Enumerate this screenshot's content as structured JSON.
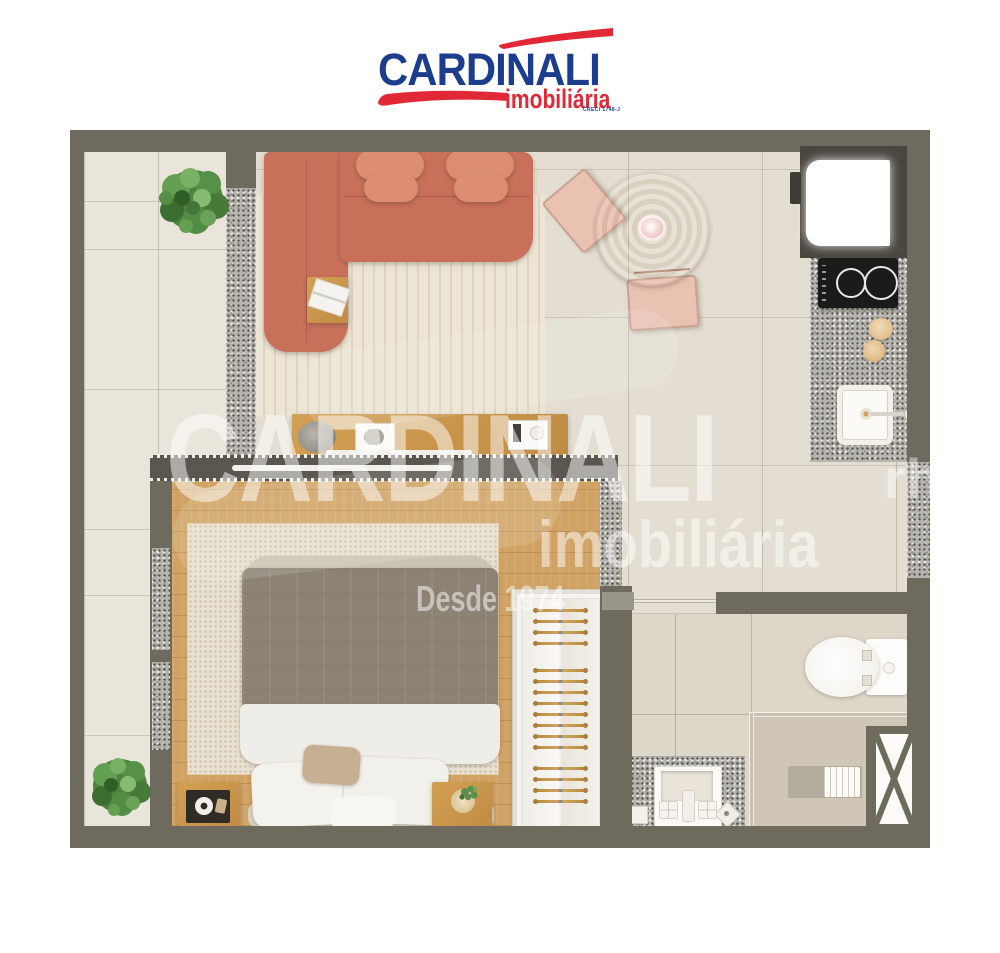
{
  "brand": {
    "name": "CARDINALI",
    "tagline": "imobiliária",
    "creci": "CRECI 1748-J",
    "colors": {
      "blue": "#1c3d8e",
      "red": "#e02837"
    }
  },
  "watermark": {
    "title": "CARDINALI",
    "subtitle": "imobiliária",
    "since": "Desde 1974",
    "fragment": "rh"
  },
  "floor_plan": {
    "description": "Top-down 3D rendered floor plan of a studio apartment",
    "rooms": [
      {
        "name": "balcony",
        "features": [
          "potted-plant-top",
          "potted-plant-bottom",
          "sliding-door-curtain"
        ]
      },
      {
        "name": "living-room",
        "features": [
          "l-shaped-coral-sofa",
          "two-coral-armchairs",
          "striped-area-rug",
          "side-table-with-magazines",
          "tv-console",
          "decor-bowl",
          "decor-trays",
          "soundbar"
        ]
      },
      {
        "name": "dining-area",
        "features": [
          "round-wood-table",
          "centerpiece-bowl",
          "two-pink-chairs"
        ]
      },
      {
        "name": "kitchen",
        "features": [
          "refrigerator",
          "two-burner-cooktop",
          "granite-counter",
          "canisters",
          "sink-with-faucet",
          "window-sill"
        ]
      },
      {
        "name": "bedroom",
        "features": [
          "double-bed",
          "gray-duvet",
          "white-pillows",
          "knit-rug",
          "nightstand-left-with-tray",
          "nightstand-right-with-plant",
          "wardrobe-with-hangers",
          "window-curtains"
        ]
      },
      {
        "name": "bathroom",
        "features": [
          "sliding-door",
          "toilet",
          "granite-vanity",
          "square-sink",
          "soap-dishes",
          "floor-drain",
          "shower-glass-partition",
          "shower-bench-with-towel",
          "service-shaft"
        ]
      }
    ]
  },
  "closet": {
    "hanger_groups": [
      4,
      8,
      4
    ]
  },
  "palette": {
    "wall": "#6e6a5e",
    "floor_tile": "#e4ded2",
    "balcony_tile": "#eae5da",
    "wood_floor": "#d0a263",
    "sofa": "#c8705a",
    "armchair": "#dd8e72",
    "dining_chair": "#eac2b2",
    "wood_furniture": "#c9974f",
    "granite": "#b6b4af",
    "cooktop": "#1b1b1b",
    "rug": "#ece4d4",
    "watermark": "rgba(255,255,255,0.5)"
  }
}
